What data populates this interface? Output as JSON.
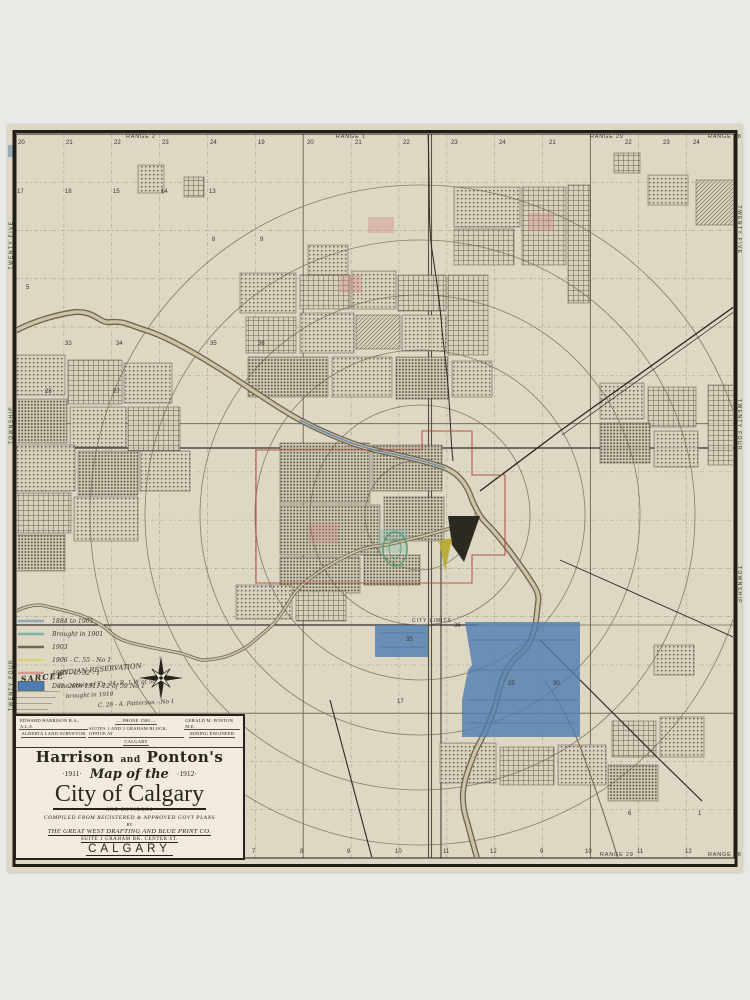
{
  "page": {
    "background": "#ebe9e6",
    "paper_color": "#ddd7c4"
  },
  "map": {
    "ink": "#38352a",
    "border_color": "#211e18",
    "credit": "ROLPH & CLARK LITHO. CO. TORONTO",
    "city_limits_label": "CITY LIMITS",
    "colors": {
      "river_outline": "#6e6350",
      "river_fill": "#cdc3a6",
      "rail": "#2b281f",
      "red_boundary": "#b0493f",
      "blue_patch": "#4f7cb0",
      "blue_line": "#4f7cb0",
      "circle": "#6b6553",
      "yellow_patch": "#b5a92f",
      "green_park": "#4f9e6e",
      "dark_feature": "#2c2922"
    },
    "range_labels_top": [
      {
        "t": "RANGE 2",
        "x": 118
      },
      {
        "t": "RANGE 1",
        "x": 328
      },
      {
        "t": "RANGE 29",
        "x": 582
      },
      {
        "t": "RANGE 28",
        "x": 700
      }
    ],
    "range_labels_bottom": [
      {
        "t": "RANGE 29",
        "x": 592
      },
      {
        "t": "RANGE 28",
        "x": 700
      }
    ],
    "top_numbers": [
      {
        "t": "20",
        "x": 10
      },
      {
        "t": "21",
        "x": 58
      },
      {
        "t": "22",
        "x": 106
      },
      {
        "t": "23",
        "x": 154
      },
      {
        "t": "24",
        "x": 202
      },
      {
        "t": "19",
        "x": 250
      },
      {
        "t": "20",
        "x": 299
      },
      {
        "t": "21",
        "x": 347
      },
      {
        "t": "22",
        "x": 395
      },
      {
        "t": "23",
        "x": 443
      },
      {
        "t": "24",
        "x": 491
      },
      {
        "t": "21",
        "x": 541
      },
      {
        "t": "22",
        "x": 617
      },
      {
        "t": "23",
        "x": 655
      },
      {
        "t": "24",
        "x": 685
      }
    ],
    "row2_numbers": [
      {
        "t": "17",
        "x": 9
      },
      {
        "t": "16",
        "x": 57
      },
      {
        "t": "15",
        "x": 105
      },
      {
        "t": "14",
        "x": 153
      },
      {
        "t": "13",
        "x": 201
      }
    ],
    "bottom_numbers": [
      {
        "t": "7",
        "x": 244
      },
      {
        "t": "8",
        "x": 292
      },
      {
        "t": "9",
        "x": 339
      },
      {
        "t": "10",
        "x": 387
      },
      {
        "t": "11",
        "x": 435
      },
      {
        "t": "12",
        "x": 482
      },
      {
        "t": "9",
        "x": 532
      },
      {
        "t": "10",
        "x": 577
      },
      {
        "t": "11",
        "x": 629
      },
      {
        "t": "12",
        "x": 677
      }
    ],
    "left_labels": [
      {
        "t": "TWENTY FIVE",
        "y": 120
      },
      {
        "t": "TOWNSHIP",
        "y": 300
      },
      {
        "t": "TWENTY FOUR",
        "y": 560
      }
    ],
    "right_labels": [
      {
        "t": "TWENTY FIVE",
        "y": 105
      },
      {
        "t": "TWENTY FOUR",
        "y": 300
      },
      {
        "t": "TOWNSHIP",
        "y": 460
      }
    ],
    "section_numbers": [
      {
        "t": "8",
        "x": 204,
        "y": 116
      },
      {
        "t": "9",
        "x": 252,
        "y": 116
      },
      {
        "t": "5",
        "x": 18,
        "y": 164
      },
      {
        "t": "33",
        "x": 57,
        "y": 220
      },
      {
        "t": "34",
        "x": 108,
        "y": 220
      },
      {
        "t": "35",
        "x": 202,
        "y": 220
      },
      {
        "t": "36",
        "x": 250,
        "y": 220
      },
      {
        "t": "28",
        "x": 37,
        "y": 268
      },
      {
        "t": "27",
        "x": 105,
        "y": 268
      },
      {
        "t": "35",
        "x": 398,
        "y": 516
      },
      {
        "t": "36",
        "x": 446,
        "y": 502
      },
      {
        "t": "25",
        "x": 500,
        "y": 560
      },
      {
        "t": "30",
        "x": 545,
        "y": 560
      },
      {
        "t": "17",
        "x": 389,
        "y": 578
      },
      {
        "t": "13",
        "x": 230,
        "y": 640
      },
      {
        "t": "12",
        "x": 112,
        "y": 660
      },
      {
        "t": "6",
        "x": 620,
        "y": 690
      },
      {
        "t": "1",
        "x": 690,
        "y": 690
      }
    ]
  },
  "legend": {
    "entries": [
      {
        "color": "#90a7b8",
        "style": "line",
        "label": "1884 to 1901"
      },
      {
        "color": "#7fb5a8",
        "style": "line",
        "label": "Brought  in  1901"
      },
      {
        "color": "#6b6b4f",
        "style": "line",
        "label": "1903"
      },
      {
        "color": "#d8d07c",
        "style": "line",
        "label": "1906   -   C. 55   -   No 1"
      },
      {
        "color": "#d6968b",
        "style": "line",
        "label": "1907   -   C. 32   -   1"
      },
      {
        "color": "#4f7cb0",
        "style": "block",
        "label": "Dec. 20th 1911-12   of  59   No 1"
      }
    ],
    "sarcee": "SARCEE",
    "reservation": "INDIAN  RESERVATION",
    "notes": [
      "The whole of Tp. 24, R. 1 W of 5th M",
      "brought  in  1910",
      "C. 28  -  A. Patterson  -  No 1"
    ]
  },
  "title_block": {
    "surveyor_name": "EDWARD HARRISON  B.A., A.L.S.",
    "surveyor_title": "ALBERTA LAND SURVEYOR",
    "phone": "— PHONE 1580 —",
    "office": "SUITES 1 AND 2 GRAHAM BLOCK, OFFICE AT",
    "office_city": "CALGARY",
    "engineer_name": "GERALD M. PONTON  M.E.",
    "engineer_title": "MINING ENGINEER",
    "name_left": "Harrison",
    "name_and": "and",
    "name_right": "Ponton's",
    "year_left": "·1911·",
    "map_of_the": "Map of the",
    "year_right": "·1912·",
    "city": "City of Calgary",
    "environs": "AND ENVIRONS",
    "compiled": "COMPILED   FROM    REGISTERED   &   APPROVED   GOVT   PLANS",
    "by": "BY",
    "company": "THE  GREAT  WEST  DRAFTING  AND  BLUE  PRINT  CO.",
    "address": "SUITE 1   GRAHAM BK.   CENTER ST.",
    "city_bottom": "CALGARY",
    "sig_left": "F. A. SHERLOCK"
  }
}
